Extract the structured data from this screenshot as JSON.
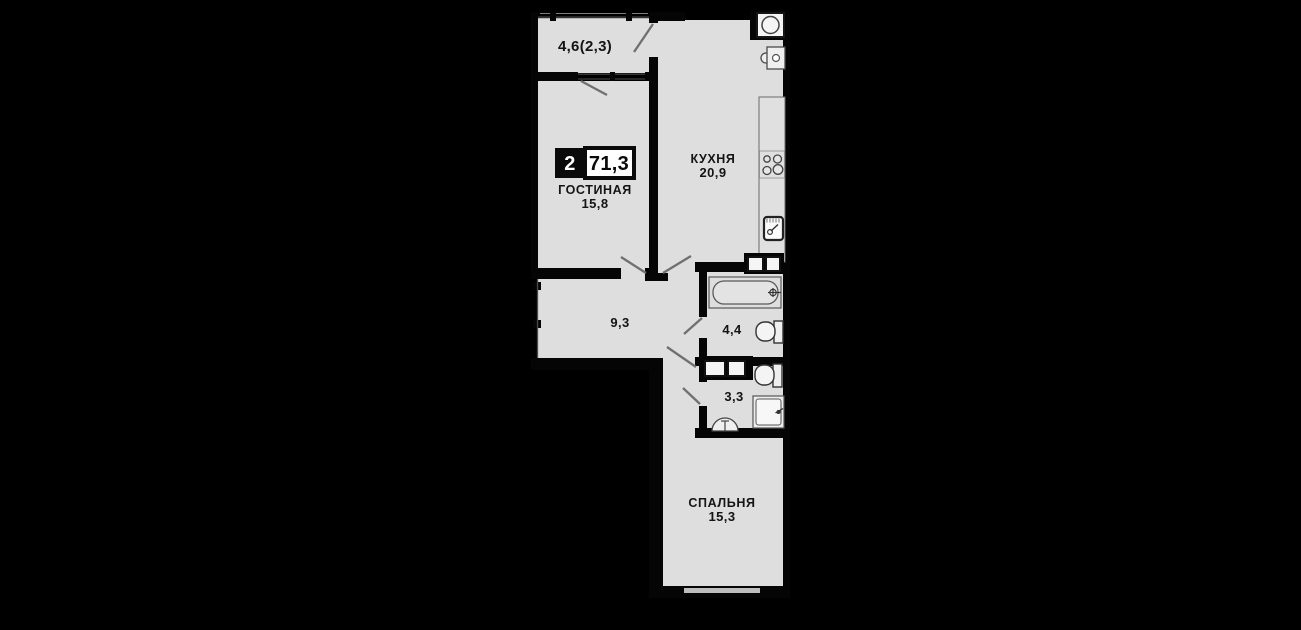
{
  "plan": {
    "badge": {
      "rooms_count": "2",
      "total_area": "71,3"
    },
    "rooms": {
      "balcony": {
        "label": "4,6(2,3)"
      },
      "living": {
        "name": "ГОСТИНАЯ",
        "area": "15,8"
      },
      "kitchen": {
        "name": "КУХНЯ",
        "area": "20,9"
      },
      "hallway": {
        "area": "9,3"
      },
      "bathroom": {
        "area": "4,4"
      },
      "wc": {
        "area": "3,3"
      },
      "bedroom": {
        "name": "СПАЛЬНЯ",
        "area": "15,3"
      }
    },
    "colors": {
      "background": "#000000",
      "floor": "#dedede",
      "wall": "#050505",
      "badge_black": "#0a0a0a",
      "badge_white": "#ffffff",
      "text": "#141414"
    }
  }
}
